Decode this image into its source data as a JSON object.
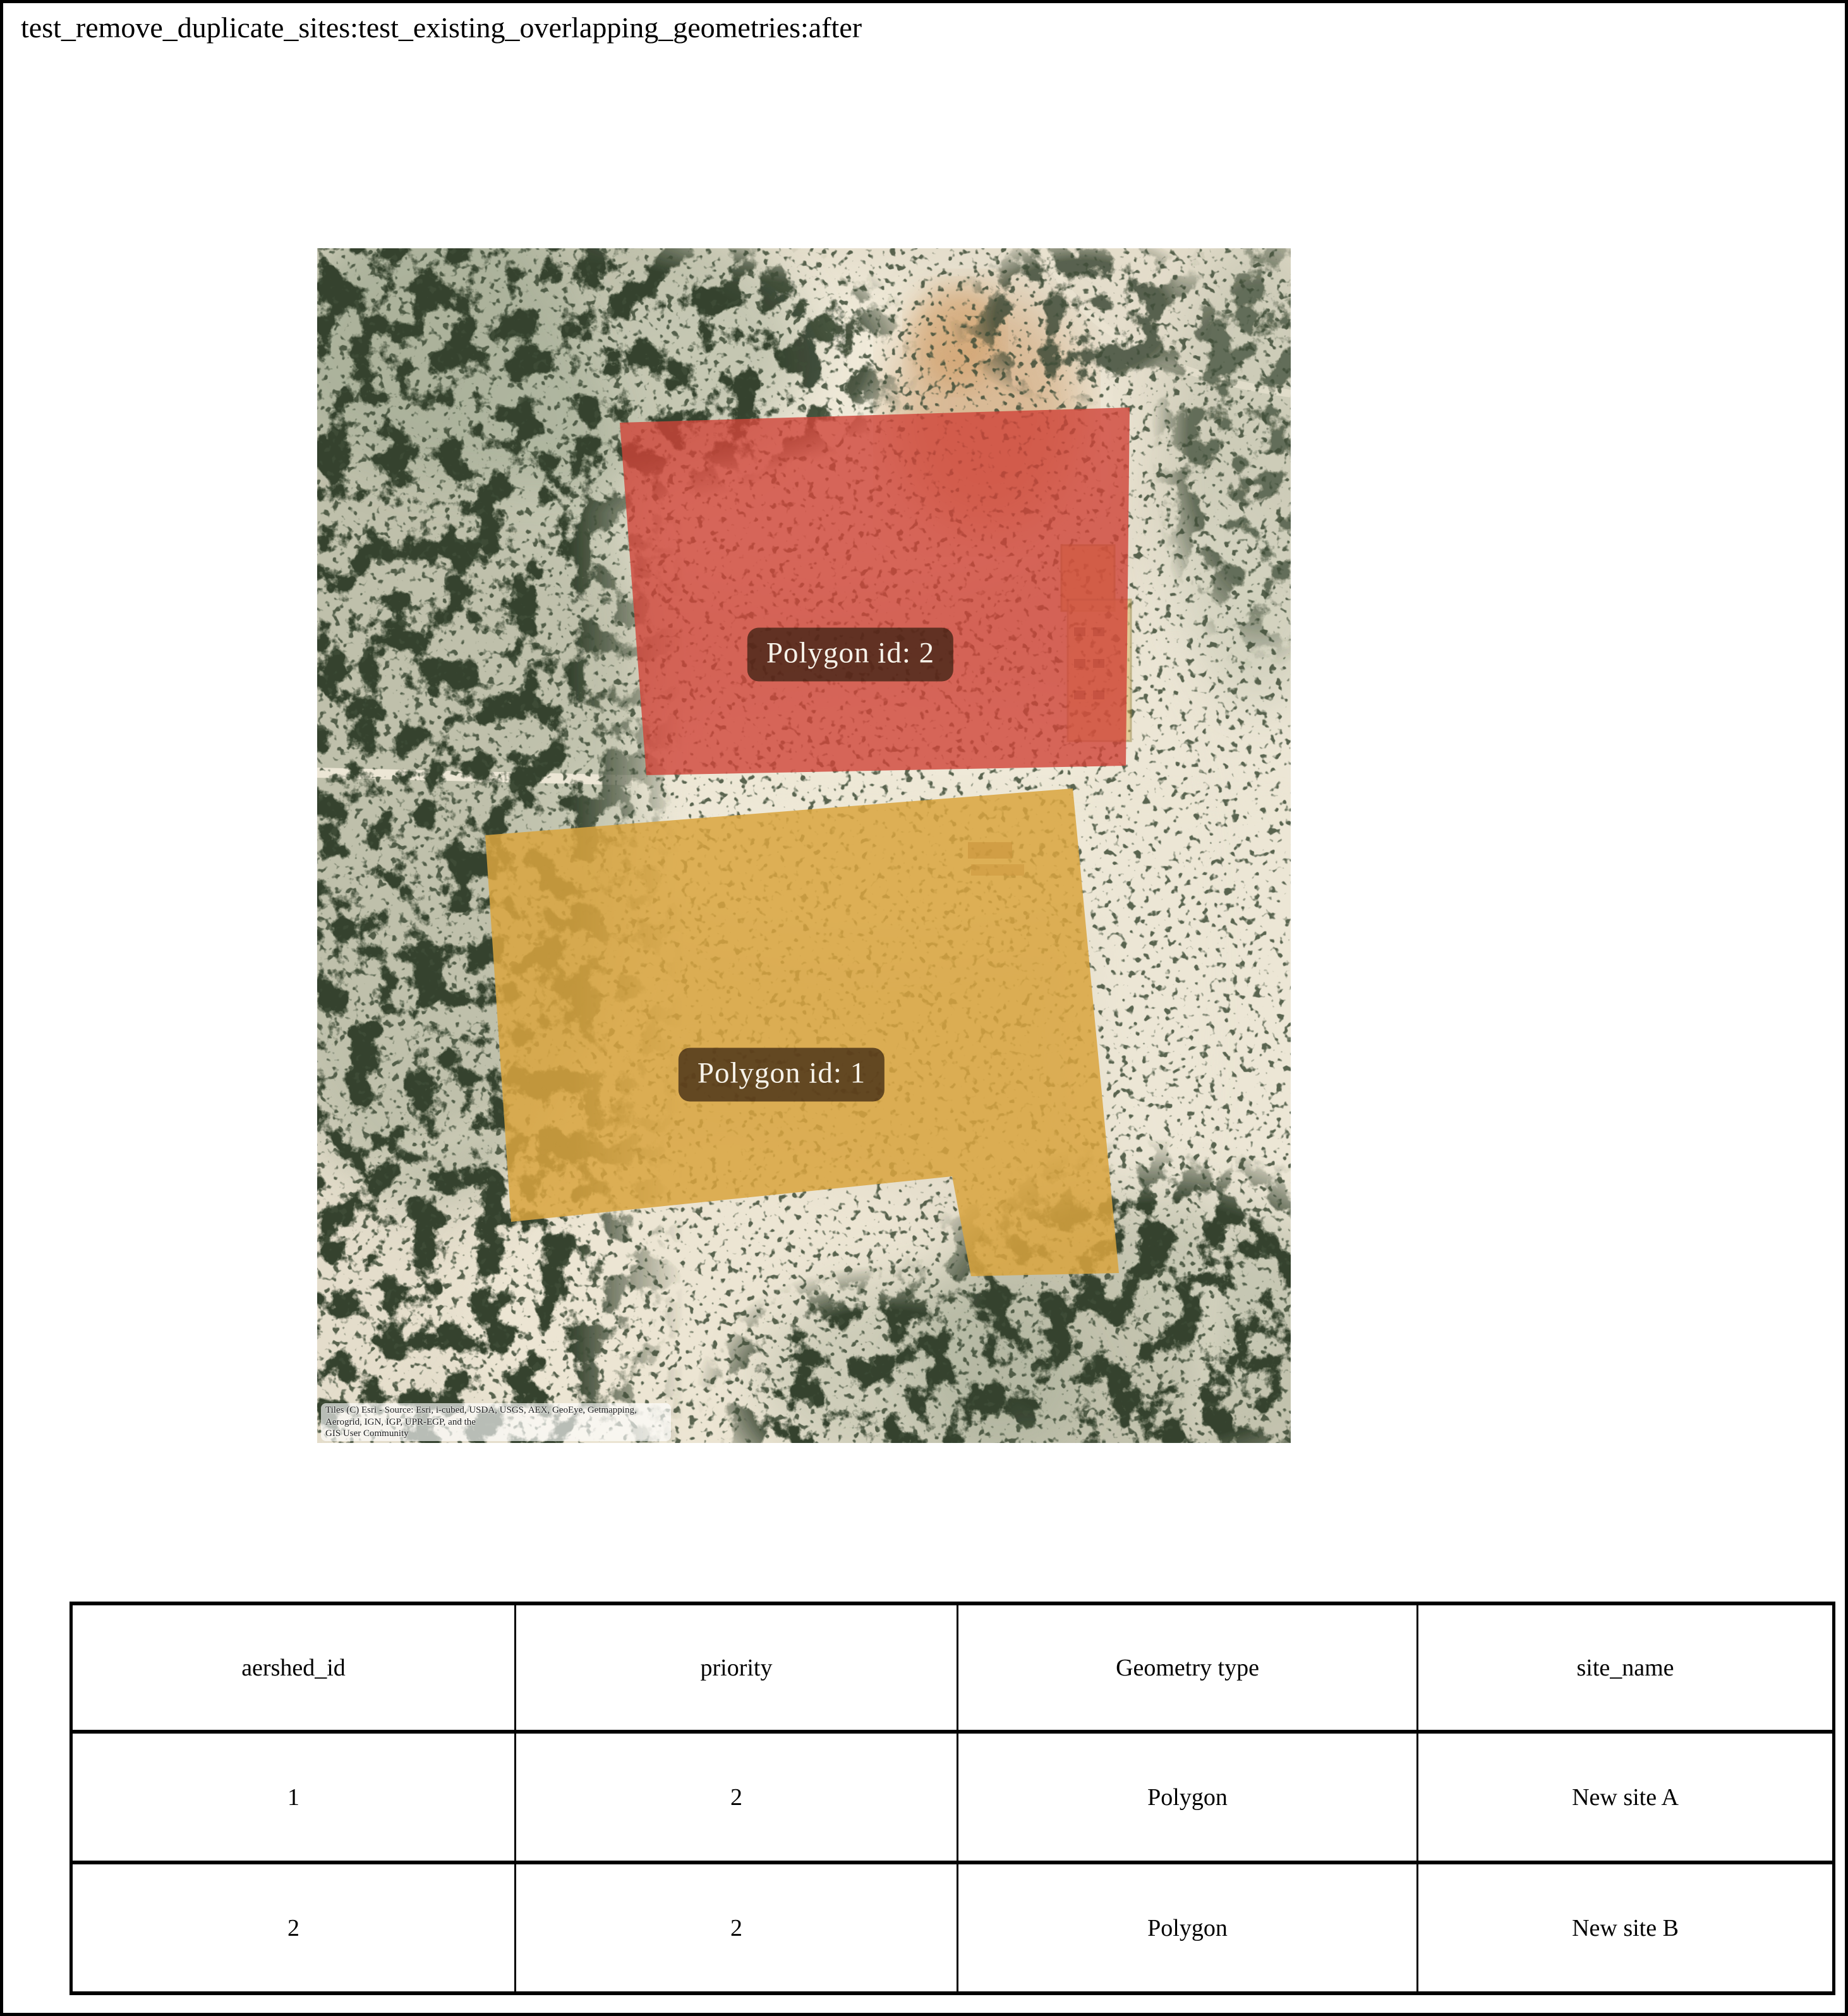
{
  "page": {
    "title": "test_remove_duplicate_sites:test_existing_overlapping_geometries:after"
  },
  "map": {
    "polygons": [
      {
        "label": "Polygon id: 2",
        "fill": "#cf4438"
      },
      {
        "label": "Polygon id: 1",
        "fill": "#d9a53e"
      }
    ],
    "attribution": {
      "line1": "Tiles (C) Esri - Source: Esri, i-cubed, USDA, USGS, AEX, GeoEye, Getmapping, Aerogrid, IGN, IGP, UPR-EGP, and the",
      "line2": "GIS User Community"
    }
  },
  "table": {
    "headers": [
      "aershed_id",
      "priority",
      "Geometry type",
      "site_name"
    ],
    "rows": [
      [
        "1",
        "2",
        "Polygon",
        "New site A"
      ],
      [
        "2",
        "2",
        "Polygon",
        "New site B"
      ]
    ]
  },
  "colors": {
    "polygon_red": "#cf4438",
    "polygon_yellow": "#d9a53e",
    "label_background": "rgba(48,28,14,0.70)",
    "label_text": "#f6f2e9",
    "scrub_green_dark": "#34422d",
    "scrub_green": "#3f4e39",
    "sand_base": "#e4ddcb"
  }
}
